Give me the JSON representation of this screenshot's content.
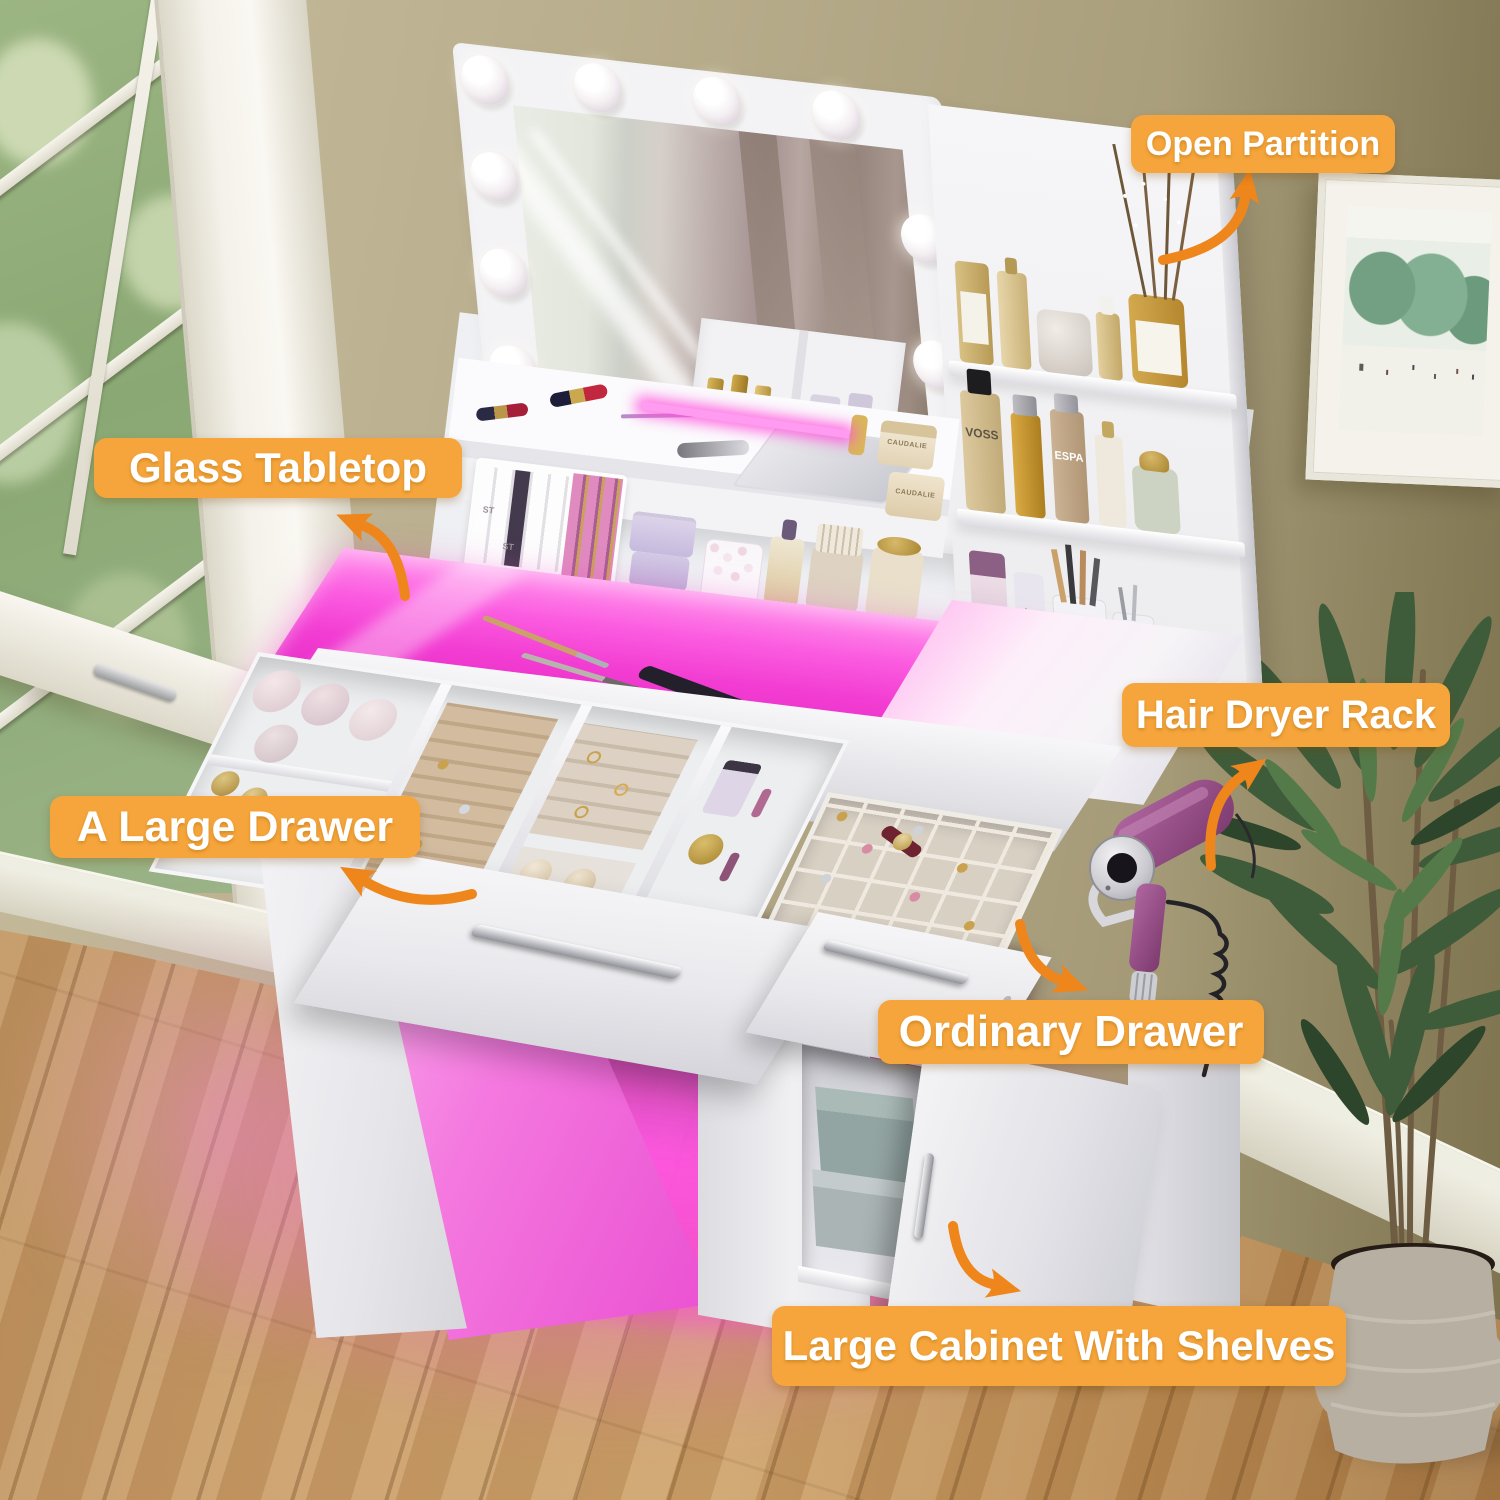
{
  "callouts": [
    {
      "id": "open-partition",
      "label": "Open Partition"
    },
    {
      "id": "glass-tabletop",
      "label": "Glass Tabletop"
    },
    {
      "id": "hair-dryer-rack",
      "label": "Hair Dryer Rack"
    },
    {
      "id": "a-large-drawer",
      "label": "A Large Drawer"
    },
    {
      "id": "ordinary-drawer",
      "label": "Ordinary Drawer"
    },
    {
      "id": "large-cabinet-with-shelves",
      "label": "Large Cabinet With Shelves"
    }
  ],
  "product_text": {
    "hairspray_brand": "VOSS",
    "skincare_bottle_brand": "ESPA",
    "lip_gloss_brand": "gloss",
    "lipstick_box_brand": "ST",
    "cream_jar_brand": "CAUDALIE"
  },
  "colors": {
    "callout_background": "#F5A53B",
    "callout_text": "#FFFFFF",
    "arrow_orange": "#EE861C",
    "led_magenta": "#F440D6",
    "furniture_white": "#F2F2F5",
    "wall_tan": "#B7AC8B",
    "floor_wood": "#C1945F",
    "hair_dryer_purple": "#96477F",
    "plant_green": "#3F5C3A"
  }
}
